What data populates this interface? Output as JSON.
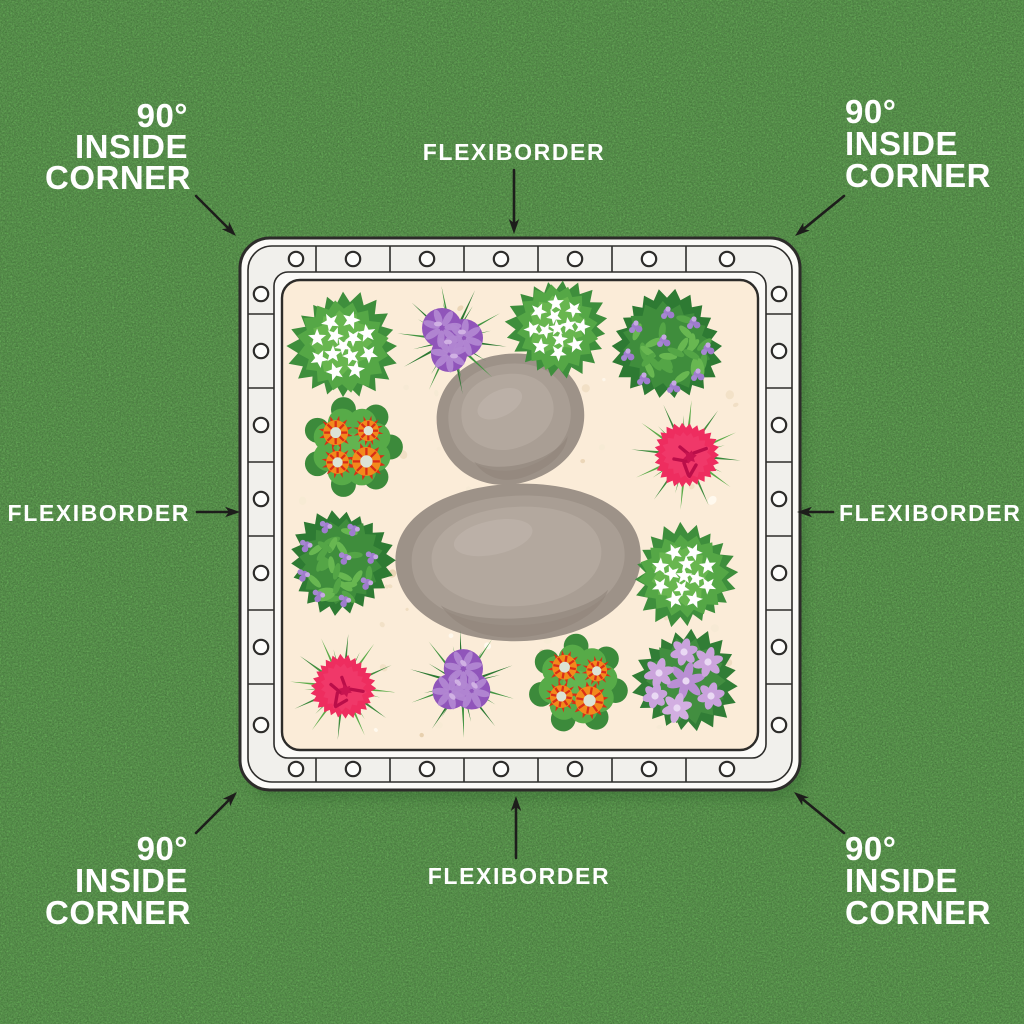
{
  "diagram": {
    "description": "Top-down illustration of a square garden flower bed edged with FlexiBorder lawn edging, annotated with corner and side part labels",
    "product_name": "FLEXIBORDER",
    "corner_part_label": "90° INSIDE CORNER",
    "side_part_label": "FLEXIBORDER",
    "holes_per_side": 7,
    "stones_count": 2,
    "plants_count": 12
  },
  "labels": {
    "top_left_corner": {
      "line1": "90°",
      "line2": "INSIDE",
      "line3": "CORNER"
    },
    "top_right_corner": {
      "line1": "90°",
      "line2": "INSIDE",
      "line3": "CORNER"
    },
    "bottom_left_corner": {
      "line1": "90°",
      "line2": "INSIDE",
      "line3": "CORNER"
    },
    "bottom_right_corner": {
      "line1": "90°",
      "line2": "INSIDE",
      "line3": "CORNER"
    },
    "flexiborder_top": "FLEXIBORDER",
    "flexiborder_left": "FLEXIBORDER",
    "flexiborder_right": "FLEXIBORDER",
    "flexiborder_bottom": "FLEXIBORDER"
  },
  "colors": {
    "grass_green": "#56a248",
    "border_white": "#fbfaf7",
    "border_band": "#f1f0ec",
    "outline_dark": "#2d2c2a",
    "soil_beige": "#fbecd8",
    "stone_gray": "#a69b91",
    "arrow_black": "#1d1d1b",
    "label_text": "#ffffff"
  },
  "plants": [
    {
      "type": "white-flower-bush",
      "flower_color": "#ffffff",
      "cx": 343,
      "cy": 346,
      "s": 1.0,
      "r": 0
    },
    {
      "type": "purple-cluster",
      "flower_color": "#9055ba",
      "cx": 452,
      "cy": 340,
      "s": 1.0,
      "r": 0
    },
    {
      "type": "white-flower-bush",
      "flower_color": "#ffffff",
      "cx": 557,
      "cy": 328,
      "s": 0.92,
      "r": 25
    },
    {
      "type": "purple-sprinkle-bush",
      "flower_color": "#9f7ccd",
      "cx": 667,
      "cy": 346,
      "s": 1.0,
      "r": 0
    },
    {
      "type": "red-primula",
      "flower_color": "#f28a1c",
      "cx": 352,
      "cy": 447,
      "s": 0.96,
      "r": 0
    },
    {
      "type": "pink-dianthus",
      "flower_color": "#ee2d5f",
      "cx": 686,
      "cy": 455,
      "s": 1.0,
      "r": 0
    },
    {
      "type": "purple-sprinkle-bush",
      "flower_color": "#9f7ccd",
      "cx": 341,
      "cy": 562,
      "s": 0.95,
      "r": 80
    },
    {
      "type": "white-flower-bush",
      "flower_color": "#ffffff",
      "cx": 684,
      "cy": 576,
      "s": 0.95,
      "r": -40
    },
    {
      "type": "pink-dianthus",
      "flower_color": "#ee2d5f",
      "cx": 343,
      "cy": 687,
      "s": 0.97,
      "r": 30
    },
    {
      "type": "purple-cluster",
      "flower_color": "#9055ba",
      "cx": 462,
      "cy": 684,
      "s": 0.98,
      "r": 45
    },
    {
      "type": "red-primula",
      "flower_color": "#f28a1c",
      "cx": 578,
      "cy": 684,
      "s": 0.95,
      "r": 10
    },
    {
      "type": "lilac-star",
      "flower_color": "#c9a2dc",
      "cx": 686,
      "cy": 681,
      "s": 1.0,
      "r": 0
    }
  ],
  "stones": [
    {
      "cx": 509,
      "cy": 420,
      "rx": 76,
      "ry": 62,
      "rot": -14
    },
    {
      "cx": 517,
      "cy": 563,
      "rx": 122,
      "ry": 80,
      "rot": -4
    }
  ]
}
